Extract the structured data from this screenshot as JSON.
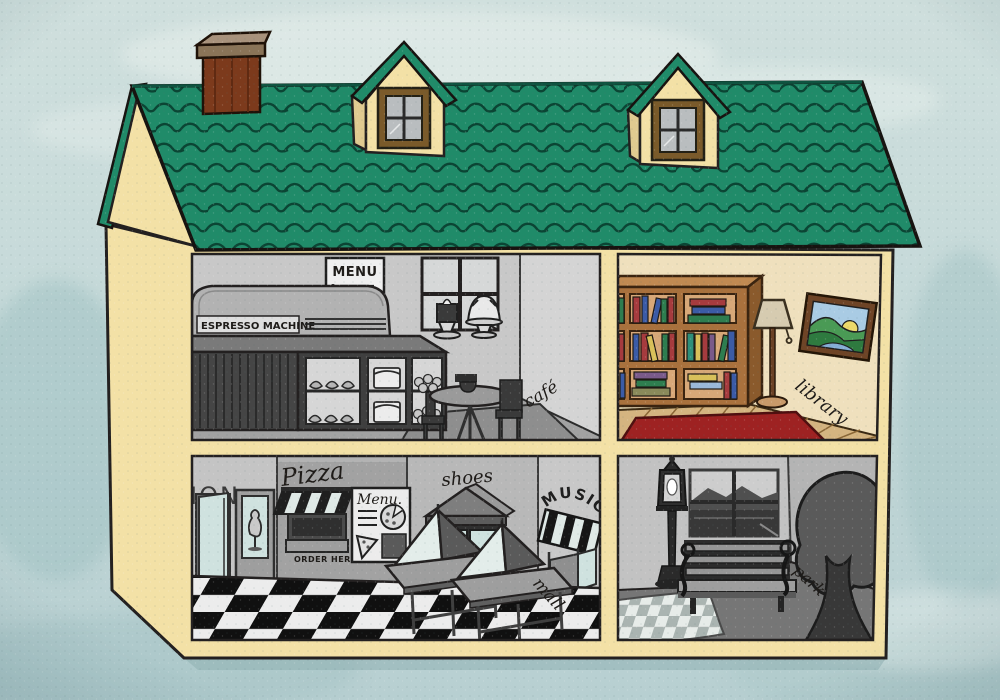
{
  "illustration": {
    "description": "Cutaway dollhouse illustration with four rooms: a café and library upstairs, a mall and park downstairs",
    "palette": {
      "sky": "#c3d8d8",
      "house_cream": "#f3e1a6",
      "roof_green": "#208b69",
      "chimney_brown": "#7c3a1c",
      "library_wall": "#efe0bd",
      "wood_floor": "#d4b480",
      "rug_red": "#9e2222",
      "glass_teal": "#cfe2df",
      "grayscale_wall": "#c6c6c6",
      "checker_dark": "#101010",
      "checker_light": "#ececec",
      "book_colors": [
        "#a63b3e",
        "#3b5ba6",
        "#2e7d4f",
        "#d8c05a",
        "#2e8f7a",
        "#7a5a8a",
        "#9ab8d8"
      ]
    }
  },
  "rooms": {
    "cafe": {
      "label": "café",
      "menu_sign": "MENU",
      "espresso_sign": "ESPRESSO MACHINE"
    },
    "library": {
      "label": "library"
    },
    "mall": {
      "label": "mall",
      "fashion_sign": "ION",
      "pizza_sign": "Pizza",
      "menu_sign": "Menu.",
      "order_sign": "ORDER HERE",
      "shoes_sign": "shoes",
      "music_sign": "MUSIC"
    },
    "park": {
      "label": "park"
    }
  }
}
